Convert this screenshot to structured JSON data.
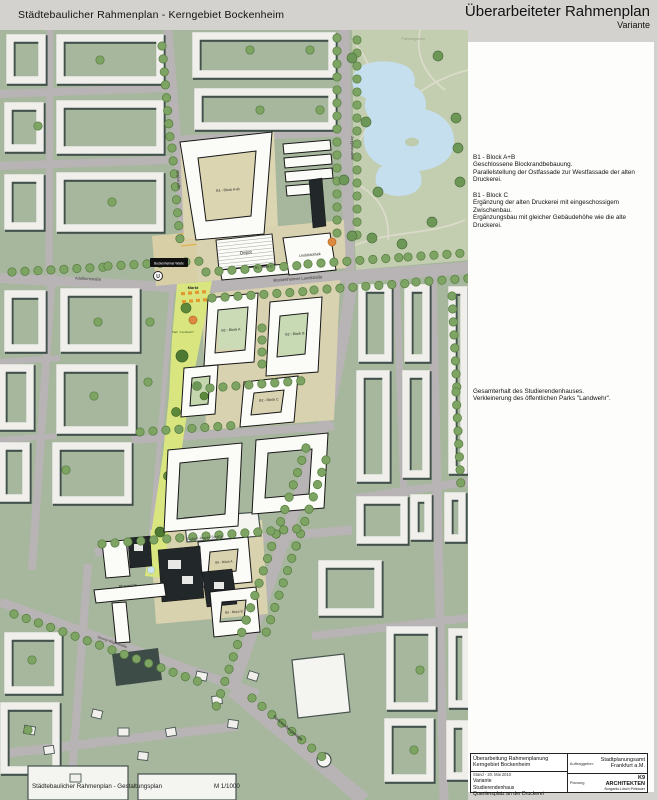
{
  "header": {
    "title_left": "Städtebaulicher Rahmenplan - Kerngebiet Bockenheim",
    "title_right": "Überarbeiteter Rahmenplan",
    "subtitle_right": "Variante"
  },
  "annotations": {
    "b1_ab_title": "B1 - Block A+B",
    "b1_ab_line1": "Geschlossene Blockrandbebauung.",
    "b1_ab_line2": "Parallelstellung der Ostfassade zur Westfassade der alten Druckerei.",
    "b1_c_title": "B1 - Block C",
    "b1_c_line1": "Ergänzung der alten Druckerei mit eingeschossigem Zwischenbau.",
    "b1_c_line2": "Ergänzungsbau mit gleicher Gebäudehöhe wie die alte Druckerei.",
    "park_line1": "Gesamterhalt des Studierendenhauses.",
    "park_line2": "Verkleinerung des öffentlichen Parks \"Landwehr\"."
  },
  "map_labels": {
    "palmengarten": "Palmengarten",
    "bockenheimer_landstrasse": "Bockenheimer Landstraße",
    "zeppelinallee": "Zeppelinallee",
    "adalbertstrasse": "Adalbertstraße",
    "graefstrasse": "Gräfstraße",
    "senckenberganlage": "Senckenberganlage",
    "robert_mayer_strasse": "Robert-Mayer-Straße",
    "georg_voigt_strasse": "Georg-Voigt-Straße",
    "warte_station": "Bockenheimer Warte",
    "ubahn": "U",
    "markt": "Markt",
    "park_landwehr": "Park \"Landwehr\"",
    "depot": "Depot",
    "unibibliothek": "Unibibliothek",
    "pharmazie": "Pharmazie",
    "b1_block_ab": "B1 - Block A+B",
    "b1_block_c": "B1 - Block C",
    "b2_block_a": "B2 - Block A",
    "b2_block_b": "B2 - Block B",
    "b2_block_c": "B2 - Block C",
    "b5_block_a": "B5 - Block A",
    "b5_block_b": "B5 - Block B"
  },
  "footer": {
    "caption": "Städtebaulicher Rahmenplan - Gestaltungsplan",
    "scale": "M 1/1000"
  },
  "title_block": {
    "project_line1": "Überarbeitung Rahmenplanung",
    "project_line2": "Kerngebiet Bockenheim",
    "date": "Stand - 20. Mai 2010",
    "variant_line1": "Variante",
    "variant_line2": "Studierendenhaus",
    "variant_line3": "Quartiersplatz an der Druckerei",
    "client_label": "Auftraggeber:",
    "client_name": "Stadtplanungsamt",
    "client_city": "Frankfurt a.M.",
    "planner_label": "Planung",
    "planner_name": "K9 ARCHITEKTEN",
    "planner_sub": "Borgards.Lösch.Piribauer"
  },
  "colors": {
    "map_green": "#a7b79d",
    "park_yellow": "#d9e67f",
    "water_blue": "#c5dfee",
    "building_black": "#22272a",
    "market_orange": "#e29a2f",
    "street_gray": "#b8b3b4"
  }
}
